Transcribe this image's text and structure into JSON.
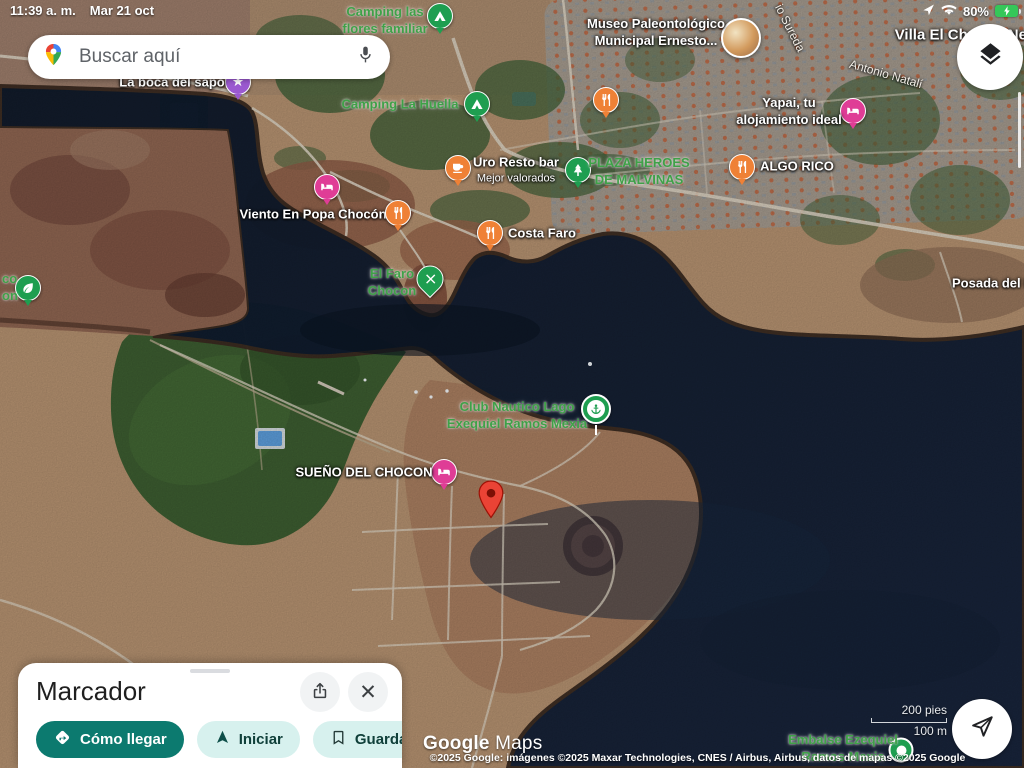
{
  "status_bar": {
    "time": "11:39 a. m.",
    "date": "Mar 21 oct",
    "battery_percent": "80%"
  },
  "search": {
    "placeholder": "Buscar aquí"
  },
  "colors": {
    "green": "#1e9e50",
    "orange": "#ef8136",
    "pink": "#df3d96",
    "purple": "#9b59d0",
    "marker_red": "#ea4335",
    "accent_teal": "#0c7a6f",
    "chip_bg": "#d7f1ee",
    "water": "#101c2e"
  },
  "map": {
    "street_labels": [
      {
        "text": "io Sureda",
        "x": 790,
        "y": 28,
        "rotate": 63
      },
      {
        "text": "Antonio Natalí",
        "x": 886,
        "y": 74,
        "rotate": 16
      }
    ],
    "pois": [
      {
        "id": "poi-camping-las-flores",
        "label": {
          "lines": [
            "Camping las",
            "flores familiar"
          ],
          "color": "green",
          "x": 385,
          "y": 21
        },
        "icon": {
          "shape": "circle",
          "glyph": "tent-icon",
          "color": "green",
          "x": 440,
          "y": 16
        }
      },
      {
        "id": "poi-museo-paleontologico",
        "label": {
          "lines": [
            "Museo Paleontológico",
            "Municipal Ernesto..."
          ],
          "color": "white",
          "x": 656,
          "y": 33
        },
        "icon": {
          "shape": "photo",
          "glyph": "photo-thumbnail",
          "color": "orange",
          "x": 741,
          "y": 38
        }
      },
      {
        "id": "poi-villa-el-chocon",
        "label": {
          "lines": [
            "Villa El Chocon Neuq"
          ],
          "color": "white",
          "size": 15,
          "x": 970,
          "y": 35
        }
      },
      {
        "id": "poi-camping-la-huella",
        "label": {
          "lines": [
            "Camping La Huella"
          ],
          "color": "green",
          "x": 400,
          "y": 105
        },
        "icon": {
          "shape": "circle",
          "glyph": "tent-icon",
          "color": "green",
          "x": 477,
          "y": 104
        }
      },
      {
        "id": "poi-restaurant-pin-1",
        "icon": {
          "shape": "circle",
          "glyph": "restaurant-icon",
          "color": "orange",
          "x": 606,
          "y": 100
        }
      },
      {
        "id": "poi-yapai-alojamiento",
        "label": {
          "lines": [
            "Yapai, tu",
            "alojamiento ideal"
          ],
          "color": "white",
          "x": 789,
          "y": 112
        },
        "icon": {
          "shape": "circle",
          "glyph": "bed-icon",
          "color": "pink",
          "x": 853,
          "y": 111
        }
      },
      {
        "id": "poi-uro-resto-bar",
        "label": {
          "lines": [
            "Uro Resto bar"
          ],
          "sublines": [
            "Mejor valorados"
          ],
          "color": "white",
          "x": 516,
          "y": 170
        },
        "icon": {
          "shape": "circle",
          "glyph": "cafe-icon",
          "color": "orange",
          "x": 458,
          "y": 168
        }
      },
      {
        "id": "poi-plaza-heroes-malvinas",
        "label": {
          "lines": [
            "PLAZA HEROES",
            "DE MALVINAS"
          ],
          "color": "green",
          "x": 639,
          "y": 172
        },
        "icon": {
          "shape": "circle",
          "glyph": "tree-icon",
          "color": "green",
          "x": 578,
          "y": 170
        }
      },
      {
        "id": "poi-algo-rico",
        "label": {
          "lines": [
            "ALGO RICO"
          ],
          "color": "white",
          "x": 797,
          "y": 167
        },
        "icon": {
          "shape": "circle",
          "glyph": "restaurant-icon",
          "color": "orange",
          "x": 742,
          "y": 167
        }
      },
      {
        "id": "poi-viento-en-popa",
        "label": {
          "lines": [
            "Viento En Popa Chocón"
          ],
          "color": "white",
          "x": 313,
          "y": 215
        },
        "icon": {
          "shape": "circle",
          "glyph": "bed-icon",
          "color": "pink",
          "x": 327,
          "y": 187
        }
      },
      {
        "id": "poi-restaurant-pin-2",
        "icon": {
          "shape": "circle",
          "glyph": "restaurant-icon",
          "color": "orange",
          "x": 398,
          "y": 213
        }
      },
      {
        "id": "poi-costa-faro",
        "label": {
          "lines": [
            "Costa Faro"
          ],
          "color": "white",
          "x": 542,
          "y": 234
        },
        "icon": {
          "shape": "circle",
          "glyph": "restaurant-icon",
          "color": "orange",
          "x": 490,
          "y": 233
        }
      },
      {
        "id": "poi-el-faro-chocon",
        "label": {
          "lines": [
            "El Faro",
            "Chocon"
          ],
          "color": "green",
          "x": 392,
          "y": 283
        },
        "icon": {
          "shape": "pin",
          "glyph": "pick-icon",
          "color": "green",
          "x": 430,
          "y": 279
        }
      },
      {
        "id": "poi-la-boca-del-sapo",
        "label": {
          "lines": [
            "La boca del sapo"
          ],
          "color": "white",
          "x": 172,
          "y": 83
        },
        "icon": {
          "shape": "circle",
          "glyph": "star-icon",
          "color": "purple",
          "x": 238,
          "y": 82
        }
      },
      {
        "id": "poi-truncated-left",
        "label": {
          "lines": [
            "co",
            "on"
          ],
          "color": "green",
          "x": 2,
          "y": 288,
          "align": "left"
        },
        "icon": {
          "shape": "circle",
          "glyph": "leaf-icon",
          "color": "green",
          "x": 28,
          "y": 288
        }
      },
      {
        "id": "poi-posada",
        "label": {
          "lines": [
            "Posada del D..."
          ],
          "color": "white",
          "x": 952,
          "y": 284,
          "align": "left"
        }
      },
      {
        "id": "poi-club-nautico",
        "label": {
          "lines": [
            "Club Nautico Lago",
            "Exequiel Ramos Mexia"
          ],
          "color": "green",
          "x": 517,
          "y": 416
        },
        "icon": {
          "shape": "balloon",
          "glyph": "anchor-icon",
          "color": "green",
          "x": 596,
          "y": 409
        }
      },
      {
        "id": "poi-sueno-del-chocon",
        "label": {
          "lines": [
            "SUEÑO DEL CHOCON"
          ],
          "color": "white",
          "x": 364,
          "y": 473
        },
        "icon": {
          "shape": "circle",
          "glyph": "bed-icon",
          "color": "pink",
          "x": 444,
          "y": 472
        }
      },
      {
        "id": "dropped-pin-marker",
        "icon": {
          "shape": "marker",
          "glyph": "red-marker-icon",
          "color": "marker_red",
          "x": 491,
          "y": 524
        }
      },
      {
        "id": "poi-embalse-ezequiel",
        "label": {
          "lines": [
            "Embalse Ezequiel",
            "Ramos Mexia"
          ],
          "color": "green",
          "x": 843,
          "y": 749
        },
        "icon": {
          "shape": "dot",
          "glyph": "dam-icon",
          "color": "green",
          "x": 901,
          "y": 750
        }
      }
    ]
  },
  "bottom_sheet": {
    "title": "Marcador",
    "actions": [
      {
        "label": "Cómo llegar"
      },
      {
        "label": "Iniciar"
      },
      {
        "label": "Guardar"
      }
    ]
  },
  "attribution": {
    "brand_a": "Google",
    "brand_b": "Maps",
    "copyright": "©2025 Google: imágenes ©2025 Maxar Technologies, CNES / Airbus, Airbus, datos de mapas ©2025 Google"
  },
  "scale": {
    "imperial": "200 pies",
    "metric": "100 m"
  }
}
